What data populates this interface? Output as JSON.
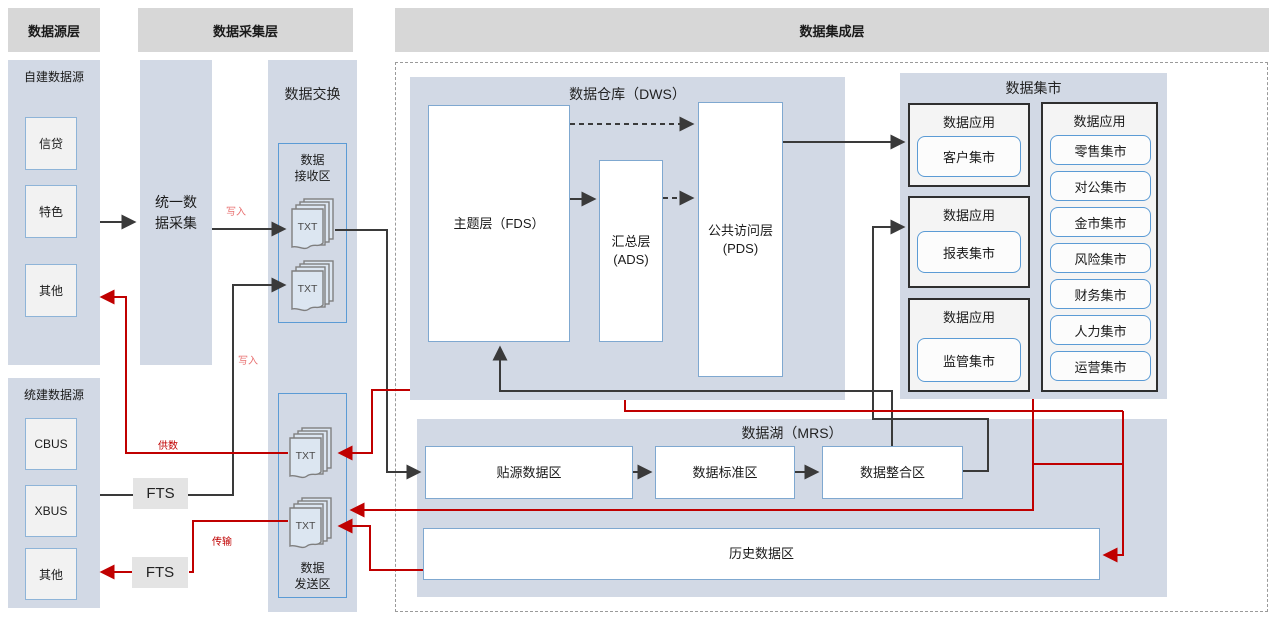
{
  "headers": {
    "source": "数据源层",
    "collection": "数据采集层",
    "integration": "数据集成层"
  },
  "panels": {
    "self_built": {
      "title": "自建数据源",
      "items": [
        "信贷",
        "特色",
        "其他"
      ]
    },
    "unified_built": {
      "title": "统建数据源",
      "items": [
        "CBUS",
        "XBUS",
        "其他"
      ]
    },
    "unified_collection": {
      "label": "统一数\n据采集"
    },
    "fts_top": "FTS",
    "fts_bottom": "FTS",
    "exchange": {
      "title": "数据交换",
      "receive": {
        "label": "数据\n接收区",
        "files": [
          "TXT",
          "TXT"
        ]
      },
      "send": {
        "label": "数据\n发送区",
        "files": [
          "TXT",
          "TXT"
        ]
      }
    },
    "dws": {
      "title": "数据仓库（DWS）",
      "fds": "主题层（FDS）",
      "ads": "汇总层\n(ADS)",
      "pds": "公共访问层\n(PDS)"
    },
    "marts": {
      "title": "数据集市",
      "groups": [
        {
          "title": "数据应用",
          "item": "客户集市"
        },
        {
          "title": "数据应用",
          "item": "报表集市"
        },
        {
          "title": "数据应用",
          "item": "监管集市"
        }
      ],
      "right_group": {
        "title": "数据应用",
        "items": [
          "零售集市",
          "对公集市",
          "金市集市",
          "风险集市",
          "财务集市",
          "人力集市",
          "运营集市"
        ]
      }
    },
    "mrs": {
      "title": "数据湖（MRS）",
      "zones": [
        "贴源数据区",
        "数据标准区",
        "数据整合区"
      ],
      "history": "历史数据区"
    }
  },
  "edge_labels": {
    "write1": "写入",
    "write2": "写入",
    "supply": "供数",
    "transfer": "传输"
  },
  "colors": {
    "red": "#c00000",
    "black": "#3a3a3a",
    "panel": "#d2d9e5",
    "header": "#d7d7d7",
    "blue_border": "#5b9bd5"
  }
}
